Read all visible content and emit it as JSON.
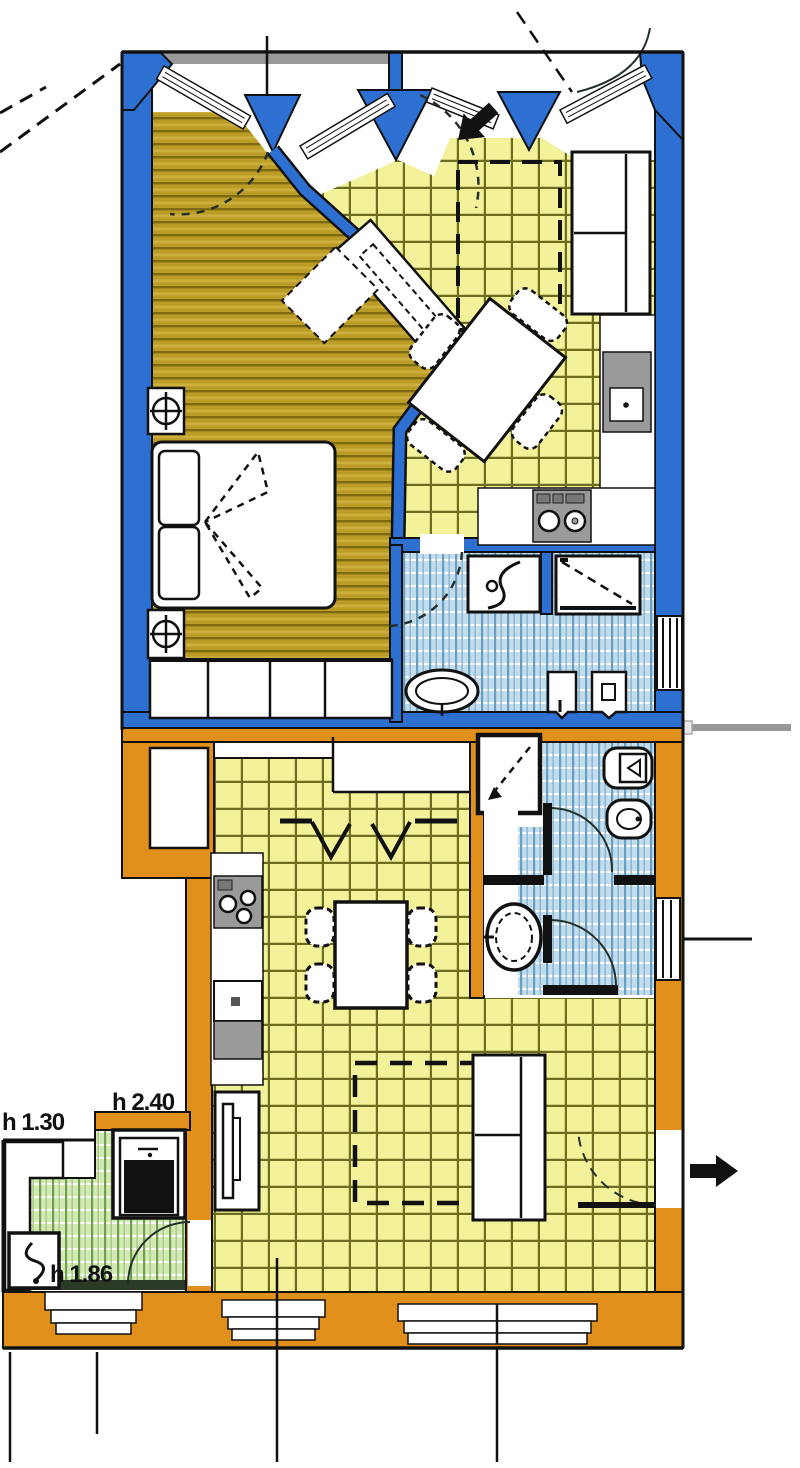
{
  "plan": {
    "annotations": {
      "height_left": "h 1.30",
      "height_center": "h 2.40",
      "height_bottom": "h 1.86"
    },
    "colors": {
      "wall-blue": "#2e6fd2",
      "wall-orange": "#e2901c",
      "floor-wood": "#bb9c27",
      "floor-wood-line": "#7e6b10",
      "floor-yellow": "#f4f19b",
      "floor-yellow-line": "#6d6d20",
      "floor-blue": "#c2dcec",
      "floor-blue-line": "#679ec2",
      "floor-green": "#d4e8b4",
      "floor-green-line": "#6fa050",
      "counter-gray": "#9a9a9a",
      "band-gray": "#999999",
      "ink": "#111111"
    }
  }
}
